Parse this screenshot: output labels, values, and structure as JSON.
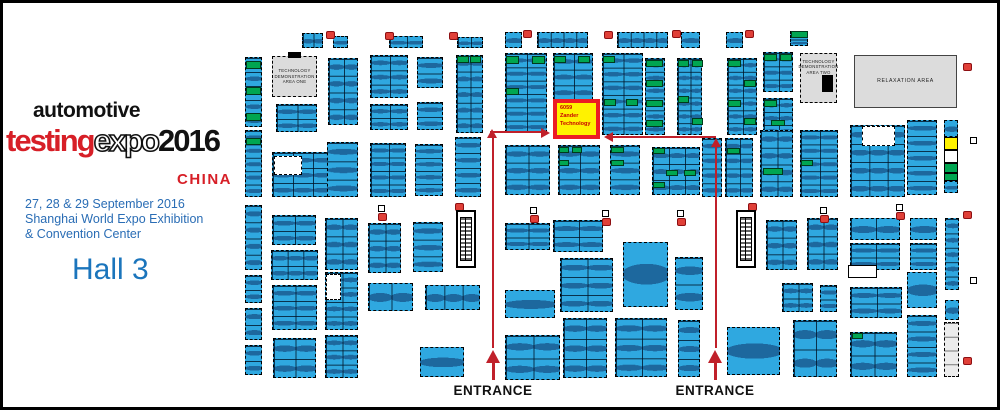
{
  "brand": {
    "line1": "automotive",
    "word_testing": "testing",
    "word_expo": "expo",
    "word_year": "2016",
    "word_china": "CHINA",
    "dates_line1": "27, 28 & 29 September 2016",
    "dates_line2": "Shanghai World Expo Exhibition",
    "dates_line3": "& Convention Center",
    "hall": "Hall 3"
  },
  "palette": {
    "booth_blue": "#2FA8E0",
    "highlight_green": "#00A651",
    "highlight_yellow": "#FFF200",
    "highlight_border_red": "#EC1C24",
    "arrow_red": "#C0202A",
    "logo_red": "#D71F27",
    "info_blue": "#2A6DB5",
    "hall_blue": "#1B75BC",
    "area_gray": "#DCDCDC"
  },
  "map": {
    "labels": {
      "entrance": "ENTRANCE",
      "tech_area_one": "TECHNOLOGY DEMONSTRATION AREA ONE",
      "tech_area_two": "TECHNOLOGY DEMONSTRATION AREA TWO",
      "relaxation": "RELAXATION AREA"
    },
    "highlight": {
      "line1": "6059",
      "line2": "Zander",
      "line3": "Technology"
    },
    "islands": [
      [
        302,
        33,
        21,
        15,
        1,
        2
      ],
      [
        333,
        36,
        15,
        12,
        1,
        1
      ],
      [
        389,
        36,
        34,
        12,
        1,
        2
      ],
      [
        457,
        37,
        26,
        11,
        1,
        2
      ],
      [
        505,
        32,
        17,
        16,
        1,
        1
      ],
      [
        537,
        32,
        51,
        16,
        1,
        4
      ],
      [
        617,
        32,
        51,
        16,
        1,
        4
      ],
      [
        681,
        32,
        19,
        16,
        1,
        1
      ],
      [
        726,
        32,
        17,
        16,
        1,
        1
      ],
      [
        790,
        31,
        18,
        15,
        2,
        1
      ],
      [
        245,
        57,
        17,
        70,
        5,
        1
      ],
      [
        245,
        130,
        17,
        67,
        5,
        1
      ],
      [
        245,
        205,
        17,
        65,
        4,
        1
      ],
      [
        245,
        275,
        17,
        28,
        2,
        1
      ],
      [
        245,
        308,
        17,
        32,
        2,
        1
      ],
      [
        245,
        345,
        17,
        30,
        2,
        1
      ],
      [
        276,
        104,
        41,
        28,
        2,
        2
      ],
      [
        272,
        152,
        60,
        45,
        3,
        3
      ],
      [
        272,
        215,
        44,
        30,
        2,
        2
      ],
      [
        271,
        250,
        47,
        30,
        2,
        3
      ],
      [
        272,
        285,
        45,
        45,
        3,
        2
      ],
      [
        273,
        338,
        43,
        40,
        2,
        2
      ],
      [
        328,
        58,
        30,
        67,
        4,
        2
      ],
      [
        327,
        142,
        31,
        55,
        3,
        1
      ],
      [
        325,
        218,
        33,
        52,
        3,
        2
      ],
      [
        325,
        272,
        33,
        58,
        4,
        2
      ],
      [
        325,
        335,
        33,
        43,
        3,
        2
      ],
      [
        370,
        55,
        38,
        43,
        3,
        2
      ],
      [
        370,
        104,
        38,
        26,
        2,
        2
      ],
      [
        370,
        143,
        36,
        54,
        4,
        2
      ],
      [
        368,
        223,
        33,
        50,
        3,
        2
      ],
      [
        368,
        283,
        45,
        28,
        1,
        2
      ],
      [
        417,
        57,
        26,
        31,
        2,
        1
      ],
      [
        417,
        102,
        26,
        28,
        2,
        1
      ],
      [
        415,
        144,
        28,
        52,
        4,
        1
      ],
      [
        413,
        222,
        30,
        50,
        3,
        1
      ],
      [
        425,
        285,
        55,
        25,
        1,
        3
      ],
      [
        420,
        347,
        44,
        30,
        1,
        1
      ],
      [
        456,
        55,
        27,
        78,
        5,
        2
      ],
      [
        455,
        137,
        26,
        60,
        4,
        1
      ],
      [
        505,
        53,
        42,
        80,
        6,
        2
      ],
      [
        553,
        53,
        40,
        47,
        3,
        2
      ],
      [
        602,
        53,
        41,
        82,
        6,
        2
      ],
      [
        645,
        58,
        20,
        77,
        6,
        1
      ],
      [
        677,
        58,
        25,
        77,
        6,
        2
      ],
      [
        727,
        58,
        30,
        77,
        6,
        2
      ],
      [
        763,
        52,
        30,
        40,
        3,
        2
      ],
      [
        763,
        98,
        30,
        39,
        3,
        2
      ],
      [
        505,
        145,
        45,
        50,
        3,
        2
      ],
      [
        558,
        145,
        42,
        50,
        3,
        2
      ],
      [
        610,
        145,
        30,
        50,
        3,
        1
      ],
      [
        652,
        147,
        48,
        48,
        3,
        3
      ],
      [
        702,
        138,
        20,
        59,
        4,
        1
      ],
      [
        725,
        138,
        28,
        59,
        4,
        2
      ],
      [
        760,
        130,
        33,
        67,
        4,
        2
      ],
      [
        800,
        130,
        38,
        67,
        5,
        2
      ],
      [
        850,
        125,
        55,
        72,
        4,
        3
      ],
      [
        907,
        120,
        30,
        75,
        5,
        1
      ],
      [
        944,
        120,
        14,
        17,
        1,
        1
      ],
      [
        944,
        137,
        14,
        13,
        1,
        1,
        "yellow"
      ],
      [
        944,
        150,
        14,
        13,
        1,
        1,
        "white"
      ],
      [
        944,
        163,
        14,
        10,
        1,
        1,
        "green"
      ],
      [
        944,
        173,
        14,
        8,
        1,
        1,
        "green"
      ],
      [
        944,
        181,
        14,
        12,
        1,
        1
      ],
      [
        945,
        218,
        14,
        72,
        5,
        1
      ],
      [
        945,
        300,
        14,
        20,
        1,
        1
      ],
      [
        944,
        322,
        15,
        55,
        4,
        1,
        "lt"
      ],
      [
        505,
        223,
        45,
        27,
        2,
        2
      ],
      [
        553,
        220,
        50,
        32,
        2,
        2
      ],
      [
        505,
        290,
        50,
        28,
        1,
        1
      ],
      [
        560,
        258,
        53,
        54,
        3,
        2
      ],
      [
        623,
        242,
        45,
        65,
        1,
        1
      ],
      [
        675,
        257,
        28,
        53,
        2,
        1
      ],
      [
        766,
        220,
        31,
        50,
        3,
        2
      ],
      [
        807,
        218,
        31,
        52,
        3,
        2
      ],
      [
        850,
        218,
        50,
        22,
        1,
        2
      ],
      [
        850,
        243,
        50,
        27,
        2,
        2
      ],
      [
        910,
        218,
        27,
        22,
        1,
        1
      ],
      [
        910,
        243,
        27,
        27,
        2,
        1
      ],
      [
        782,
        283,
        31,
        29,
        2,
        2
      ],
      [
        820,
        285,
        17,
        27,
        2,
        1
      ],
      [
        793,
        320,
        44,
        57,
        2,
        2
      ],
      [
        850,
        287,
        52,
        31,
        2,
        2
      ],
      [
        850,
        332,
        47,
        45,
        2,
        2
      ],
      [
        907,
        272,
        30,
        36,
        1,
        1
      ],
      [
        907,
        315,
        30,
        62,
        4,
        1
      ],
      [
        505,
        335,
        55,
        45,
        2,
        2
      ],
      [
        563,
        318,
        44,
        60,
        3,
        2
      ],
      [
        615,
        318,
        52,
        59,
        3,
        2
      ],
      [
        678,
        320,
        22,
        57,
        3,
        1
      ],
      [
        727,
        327,
        53,
        48,
        1,
        1
      ],
      [
        848,
        265,
        29,
        13,
        1,
        1,
        "white"
      ]
    ],
    "green_cells": [
      [
        246,
        61,
        15,
        8
      ],
      [
        246,
        87,
        15,
        8
      ],
      [
        246,
        113,
        15,
        8
      ],
      [
        246,
        138,
        15,
        7
      ],
      [
        457,
        56,
        12,
        7
      ],
      [
        470,
        56,
        11,
        7
      ],
      [
        506,
        56,
        13,
        8
      ],
      [
        532,
        56,
        13,
        8
      ],
      [
        506,
        88,
        13,
        7
      ],
      [
        554,
        56,
        12,
        7
      ],
      [
        578,
        56,
        12,
        7
      ],
      [
        603,
        56,
        12,
        7
      ],
      [
        604,
        99,
        12,
        7
      ],
      [
        626,
        99,
        12,
        7
      ],
      [
        646,
        60,
        17,
        7
      ],
      [
        646,
        80,
        17,
        7
      ],
      [
        646,
        100,
        17,
        7
      ],
      [
        646,
        120,
        17,
        7
      ],
      [
        678,
        60,
        11,
        7
      ],
      [
        692,
        60,
        11,
        7
      ],
      [
        678,
        96,
        11,
        7
      ],
      [
        692,
        118,
        11,
        7
      ],
      [
        728,
        60,
        13,
        7
      ],
      [
        744,
        80,
        12,
        7
      ],
      [
        728,
        100,
        13,
        7
      ],
      [
        744,
        118,
        12,
        7
      ],
      [
        764,
        54,
        13,
        7
      ],
      [
        780,
        54,
        12,
        7
      ],
      [
        764,
        100,
        13,
        7
      ],
      [
        791,
        31,
        17,
        7
      ],
      [
        559,
        147,
        10,
        6
      ],
      [
        572,
        147,
        10,
        6
      ],
      [
        559,
        160,
        10,
        6
      ],
      [
        611,
        147,
        13,
        6
      ],
      [
        611,
        160,
        13,
        6
      ],
      [
        653,
        148,
        12,
        6
      ],
      [
        666,
        170,
        12,
        6
      ],
      [
        684,
        170,
        12,
        6
      ],
      [
        653,
        182,
        12,
        6
      ],
      [
        727,
        148,
        13,
        6
      ],
      [
        763,
        168,
        20,
        7
      ],
      [
        801,
        160,
        12,
        6
      ],
      [
        771,
        120,
        14,
        6
      ],
      [
        852,
        333,
        11,
        6
      ]
    ],
    "white_cells": [
      [
        274,
        156,
        28,
        19
      ],
      [
        326,
        274,
        15,
        26
      ],
      [
        862,
        126,
        33,
        20
      ]
    ],
    "black_marks": [
      [
        288,
        52,
        13,
        6
      ],
      [
        822,
        75,
        11,
        17
      ]
    ],
    "red_icons": [
      [
        326,
        31
      ],
      [
        385,
        32
      ],
      [
        449,
        32
      ],
      [
        523,
        30
      ],
      [
        604,
        31
      ],
      [
        672,
        30
      ],
      [
        745,
        30
      ],
      [
        963,
        63
      ],
      [
        455,
        203
      ],
      [
        748,
        203
      ],
      [
        378,
        213
      ],
      [
        530,
        215
      ],
      [
        602,
        218
      ],
      [
        677,
        218
      ],
      [
        820,
        215
      ],
      [
        896,
        212
      ],
      [
        963,
        211
      ],
      [
        963,
        357
      ]
    ],
    "pillar_icons": [
      [
        378,
        205
      ],
      [
        530,
        207
      ],
      [
        602,
        210
      ],
      [
        677,
        210
      ],
      [
        820,
        207
      ],
      [
        896,
        204
      ],
      [
        970,
        137
      ],
      [
        970,
        277
      ]
    ],
    "escalators": [
      [
        456,
        210
      ],
      [
        736,
        210
      ]
    ],
    "route_lines": [
      [
        492,
        138,
        2,
        210
      ],
      [
        490,
        131,
        52,
        2
      ],
      [
        613,
        136,
        103,
        2
      ],
      [
        715,
        147,
        2,
        201
      ],
      [
        492,
        362,
        3,
        18
      ],
      [
        714,
        362,
        3,
        18
      ]
    ],
    "route_heads": [
      [
        541,
        128,
        "right",
        0
      ],
      [
        487,
        129,
        "up",
        0
      ],
      [
        604,
        132,
        "left",
        0
      ],
      [
        711,
        138,
        "up",
        0
      ],
      [
        486,
        350,
        "up",
        1
      ],
      [
        708,
        350,
        "up",
        1
      ]
    ],
    "entrances": [
      [
        428,
        383
      ],
      [
        650,
        383
      ]
    ]
  }
}
